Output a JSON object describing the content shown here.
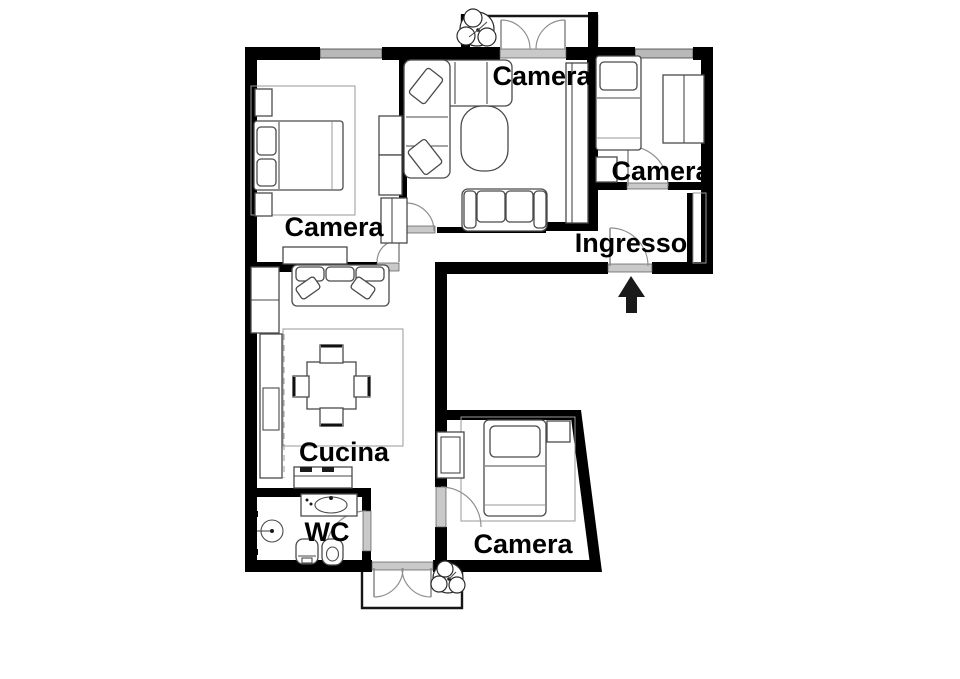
{
  "plan": {
    "rooms": [
      {
        "id": "camera-nord-ovest",
        "label": "Camera"
      },
      {
        "id": "camera-centrale",
        "label": "Camera"
      },
      {
        "id": "camera-nord-est",
        "label": "Camera"
      },
      {
        "id": "ingresso",
        "label": "Ingresso"
      },
      {
        "id": "cucina",
        "label": "Cucina"
      },
      {
        "id": "wc",
        "label": "WC"
      },
      {
        "id": "camera-sud",
        "label": "Camera"
      }
    ],
    "colors": {
      "wall": "#000000",
      "window": "#b9b9b9",
      "furniture": "#4a4a4a",
      "door_arc": "#8f8f8f",
      "threshold": "#c9c9c9"
    }
  }
}
